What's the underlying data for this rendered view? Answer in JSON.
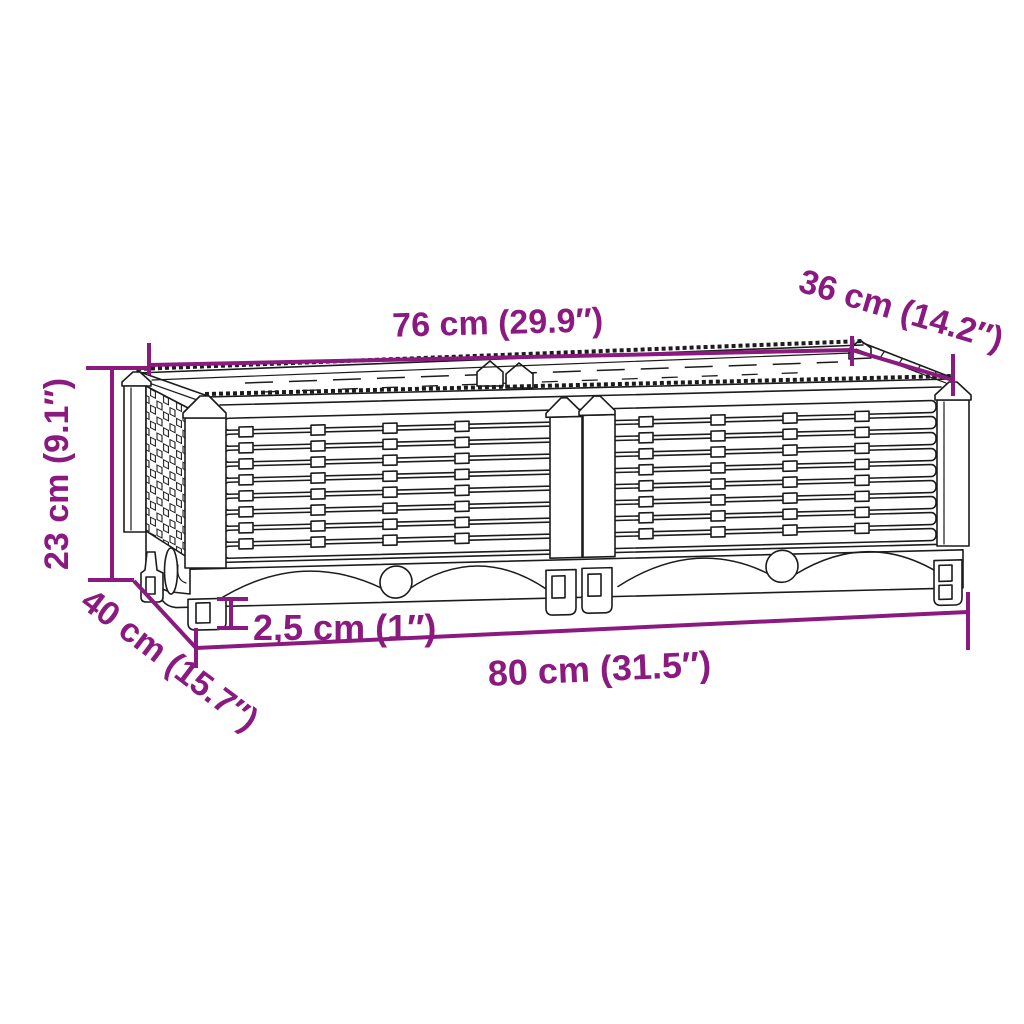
{
  "diagram": {
    "type": "product-dimension-diagram",
    "background_color": "#ffffff",
    "accent_color": "#8B1A80",
    "line_color": "#1c1c1c",
    "dimensions": {
      "top_width": "76 cm (29.9″)",
      "top_depth": "36 cm (14.2″)",
      "height": "23 cm (9.1″)",
      "bottom_depth": "40 cm (15.7″)",
      "foot_height": "2,5 cm (1″)",
      "bottom_width": "80 cm (31.5″)"
    }
  }
}
